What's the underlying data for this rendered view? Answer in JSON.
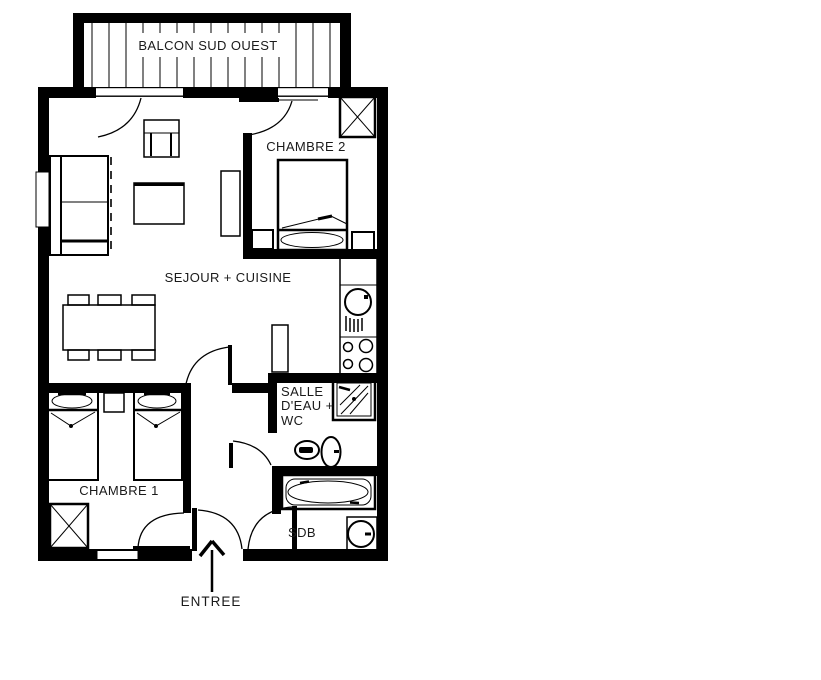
{
  "diagram": {
    "type": "apartment-floor-plan",
    "colors": {
      "background": "#ffffff",
      "walls": "#000000",
      "text": "#1a1a1a"
    }
  },
  "rooms": {
    "balcony": {
      "label": "BALCON SUD OUEST"
    },
    "bedroom_2": {
      "label": "CHAMBRE 2"
    },
    "living_kitchen": {
      "label": "SEJOUR + CUISINE"
    },
    "shower_room_wc": {
      "line1": "SALLE",
      "line2": "D'EAU +",
      "line3": "WC"
    },
    "bedroom_1": {
      "label": "CHAMBRE 1"
    },
    "bathroom": {
      "label": "SDB"
    },
    "entrance": {
      "label": "ENTREE"
    }
  },
  "furniture_icons": [
    "sofa-icon",
    "armchair-icon",
    "coffee-table-icon",
    "tv-stand-icon",
    "dining-table-icon",
    "chair-icon",
    "kitchen-sink-icon",
    "hob-icon",
    "double-bed-icon",
    "single-bed-icon",
    "nightstand-icon",
    "wardrobe-icon",
    "shower-icon",
    "toilet-icon",
    "washbasin-icon",
    "bathtub-icon",
    "entry-arrow-icon",
    "door-swing-icon",
    "balcony-railing-icon",
    "window-icon"
  ]
}
